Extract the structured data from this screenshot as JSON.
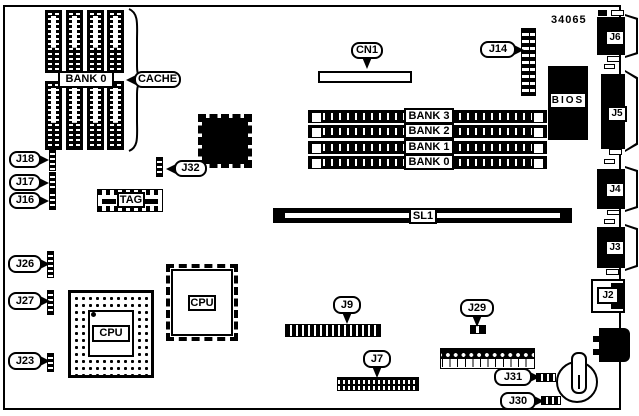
{
  "doc": {
    "part_number": "34065"
  },
  "cache": {
    "bank_label": "BANK 0",
    "label": "CACHE",
    "tag_label": "TAG"
  },
  "memory": {
    "bank_labels": [
      "BANK 3",
      "BANK 2",
      "BANK 1",
      "BANK 0"
    ]
  },
  "cpu": {
    "pga_label": "CPU",
    "qfp_label": "CPU"
  },
  "chips": {
    "bios": "BIOS"
  },
  "slots": {
    "cn1": "CN1",
    "sl1": "SL1"
  },
  "connectors": {
    "j2": "J2",
    "j3": "J3",
    "j4": "J4",
    "j5": "J5",
    "j6": "J6",
    "j7": "J7",
    "j9": "J9",
    "j14": "J14"
  },
  "jumpers": {
    "j16": "J16",
    "j17": "J17",
    "j18": "J18",
    "j23": "J23",
    "j26": "J26",
    "j27": "J27",
    "j29": "J29",
    "j30": "J30",
    "j31": "J31",
    "j32": "J32"
  },
  "colors": {
    "ink": "#000000",
    "paper": "#ffffff"
  }
}
